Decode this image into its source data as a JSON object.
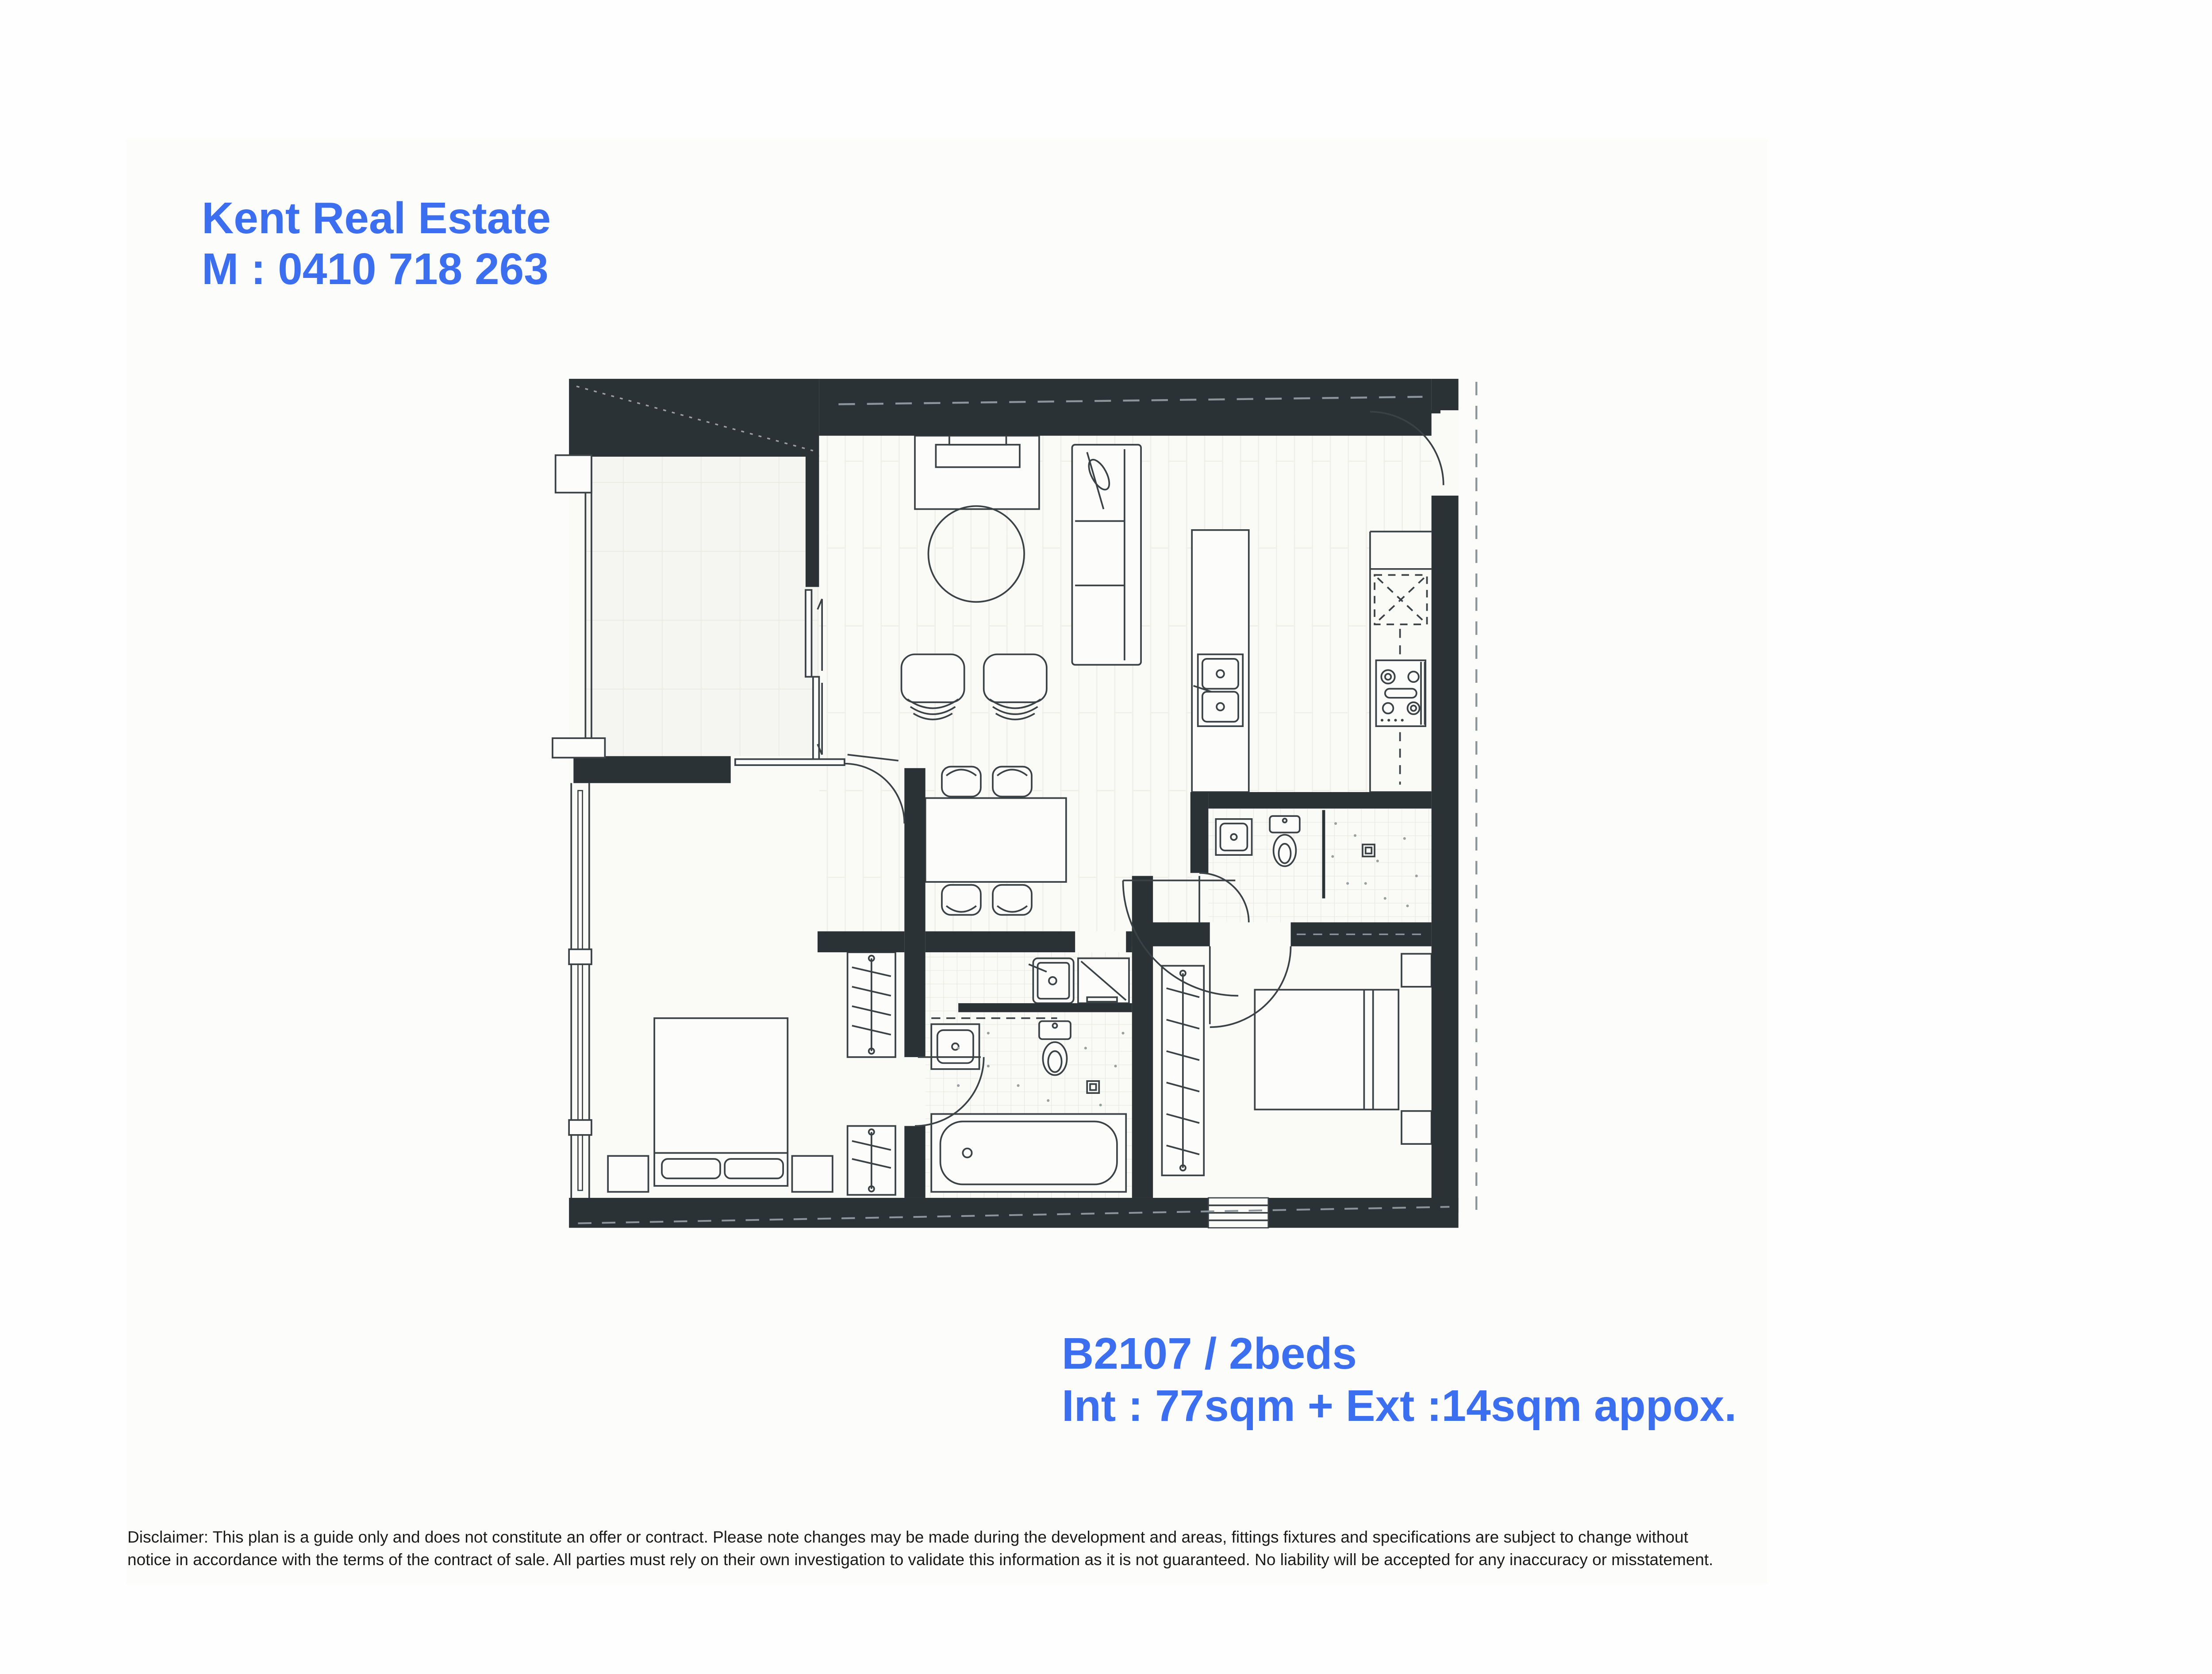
{
  "page": {
    "background_color": "#FFFFFF",
    "accent_color": "#3B6FF0",
    "wall_color": "#2A3236"
  },
  "header": {
    "company": "Kent Real Estate",
    "mobile": "M : 0410 718 263"
  },
  "unit_info": {
    "unit_label": "B2107 / 2beds",
    "area_label": "Int : 77sqm + Ext :14sqm appox."
  },
  "disclaimer": {
    "line1": "Disclaimer: This plan is a guide only and does not constitute an offer or contract. Please note changes may be made during the development and areas, fittings fixtures and specifications are subject to change without",
    "line2": "notice in accordance with the terms of the contract of sale. All parties must rely on their own investigation to validate this information as it is not guaranteed. No liability will be accepted for any inaccuracy or misstatement."
  },
  "floor_plan": {
    "rooms": [
      "balcony",
      "living-dining",
      "kitchen",
      "entry",
      "hallway",
      "bedroom-1",
      "bedroom-2",
      "bathroom-laundry",
      "ensuite"
    ],
    "fixtures": [
      "tv-unit",
      "sofa",
      "round-rug",
      "armchair-x2",
      "dining-table",
      "dining-chair-x4",
      "kitchen-island-double-sink",
      "fridge-space",
      "gas-cooktop",
      "queen-bed-x2",
      "bedside-table-x4",
      "wardrobe-x3",
      "toilet-x2",
      "vanity-x2",
      "bathtub",
      "shower",
      "laundry-tub",
      "dryer",
      "entry-door",
      "sliding-doors",
      "windows"
    ]
  }
}
